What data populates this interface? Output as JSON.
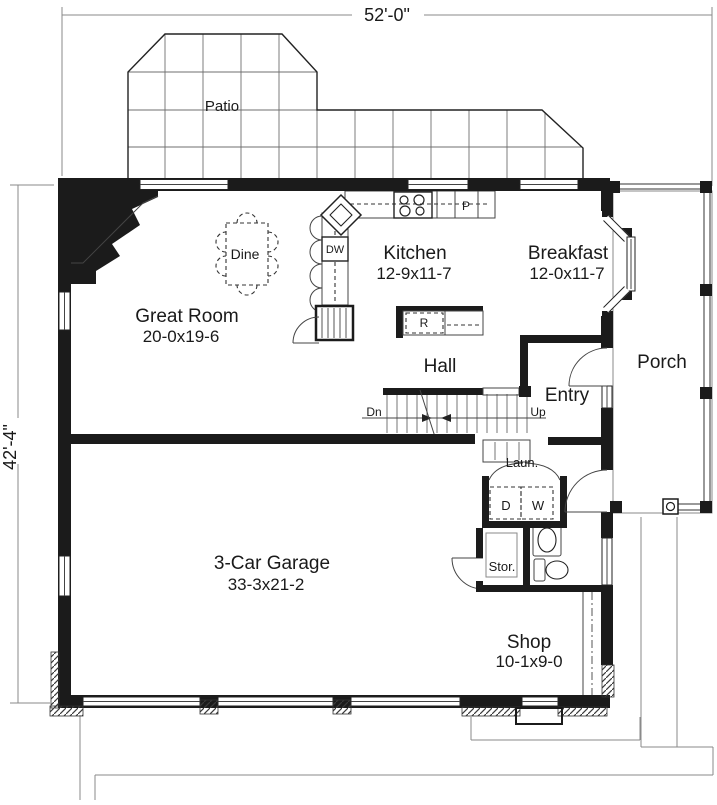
{
  "dimensions": {
    "width": "52'-0\"",
    "height": "42'-4\""
  },
  "outdoor": {
    "patio": "Patio",
    "porch": "Porch"
  },
  "rooms": {
    "great_room": {
      "name": "Great Room",
      "size": "20-0x19-6"
    },
    "kitchen": {
      "name": "Kitchen",
      "size": "12-9x11-7"
    },
    "breakfast": {
      "name": "Breakfast",
      "size": "12-0x11-7"
    },
    "garage": {
      "name": "3-Car Garage",
      "size": "33-3x21-2"
    },
    "shop": {
      "name": "Shop",
      "size": "10-1x9-0"
    }
  },
  "labels": {
    "hall": "Hall",
    "entry": "Entry",
    "dine": "Dine",
    "laundry": "Laun.",
    "storage": "Stor."
  },
  "stairs": {
    "down": "Dn",
    "up": "Up"
  },
  "appliances": {
    "dishwasher": "DW",
    "pantry": "P",
    "range": "R",
    "dryer": "D",
    "washer": "W"
  },
  "colors": {
    "wall": "#1b1b1b",
    "line": "#444444",
    "background": "#ffffff"
  }
}
